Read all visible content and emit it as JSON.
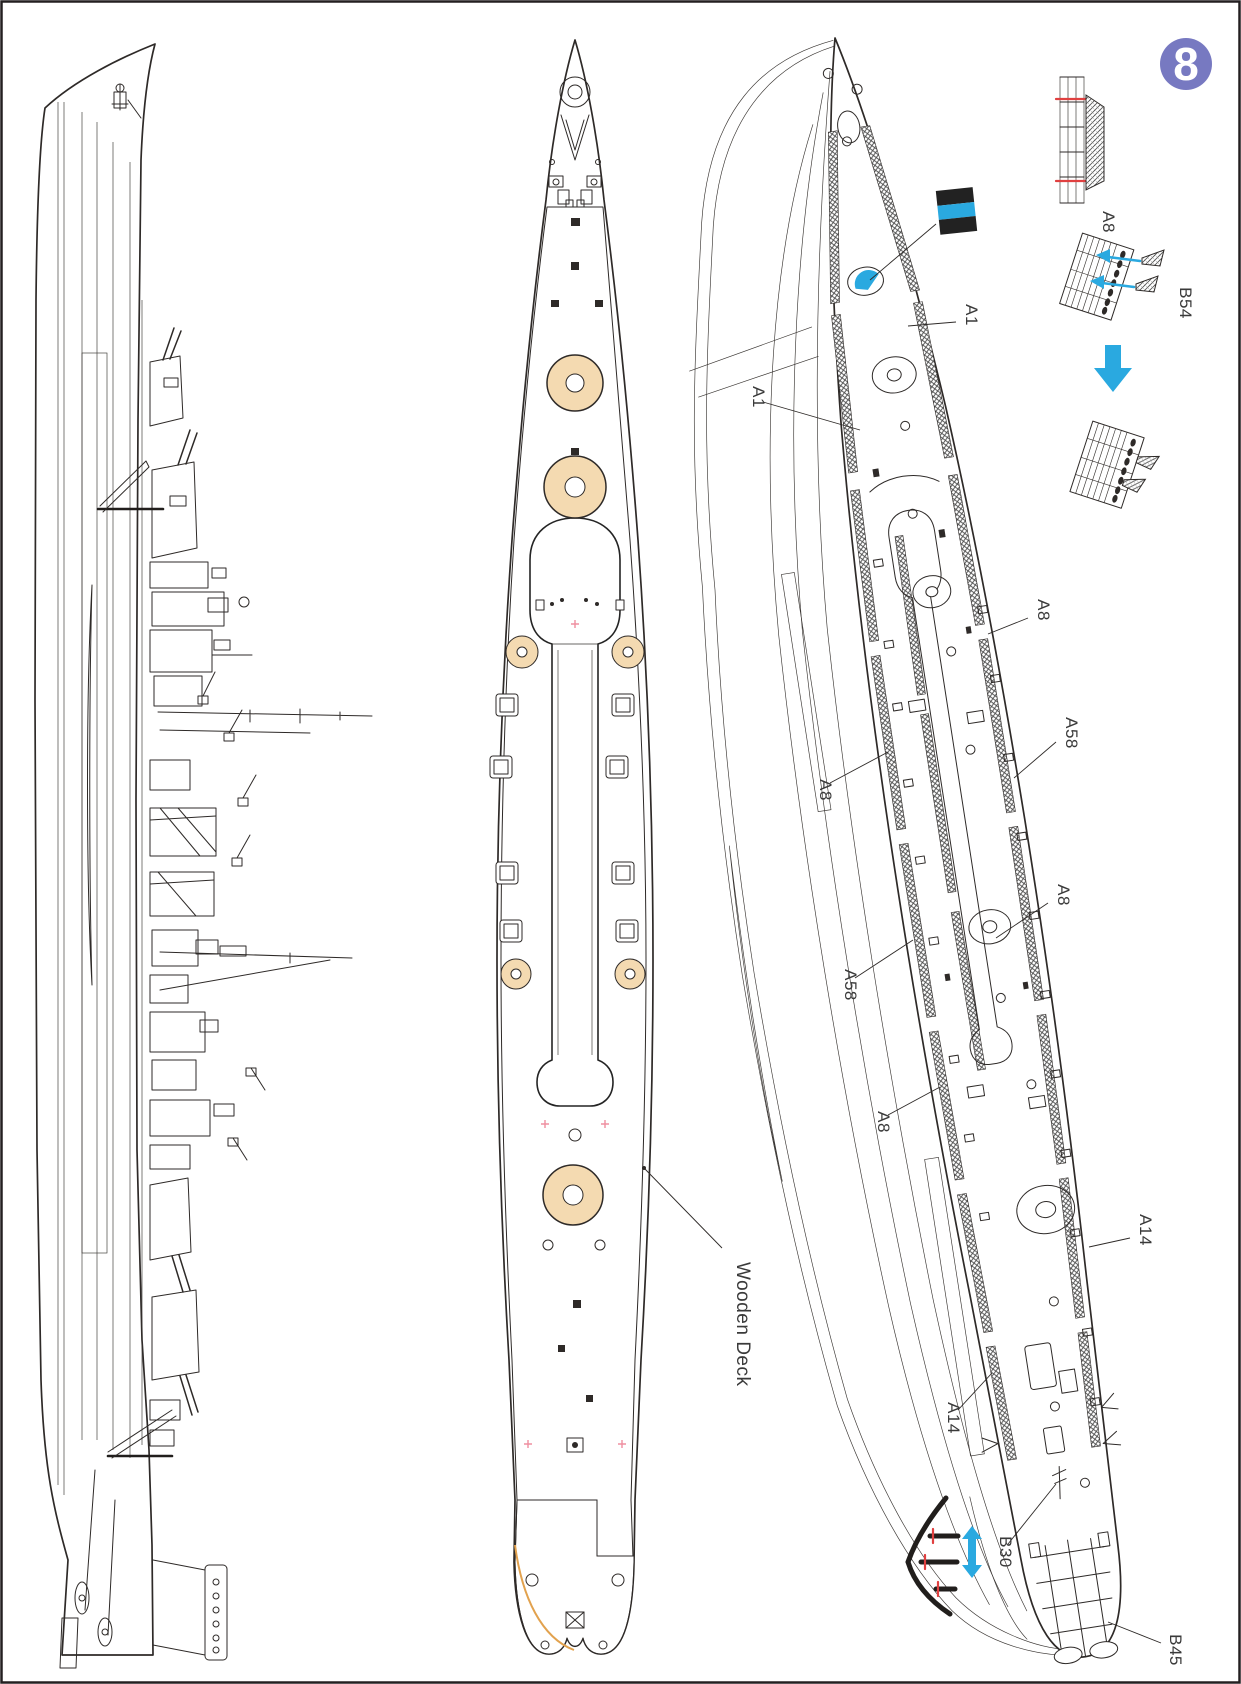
{
  "page": {
    "step_number": "8"
  },
  "colors": {
    "accent_blue": "#2aa9e0",
    "marking_red": "#e04040",
    "badge_purple": "#7779c1",
    "deck_tan": "#f4dab1",
    "plank_line": "#d09a68",
    "line_art": "#2e2a28",
    "label_text": "#3a3a3a",
    "stripe_marking": [
      "#222222",
      "#2aa9e0",
      "#222222"
    ]
  },
  "labels": {
    "wooden_deck": "Wooden Deck",
    "assembly_a8": "A8",
    "assembly_b54": "B54",
    "a1_upper": "A1",
    "a1_lower": "A1",
    "a8_right_fore": "A8",
    "a58_right": "A58",
    "a8_left_fore": "A8",
    "a8_right_mid": "A8",
    "a58_left": "A58",
    "a8_left_aft": "A8",
    "a14_right": "A14",
    "a14_left": "A14",
    "b30": "B30",
    "b45": "B45"
  }
}
